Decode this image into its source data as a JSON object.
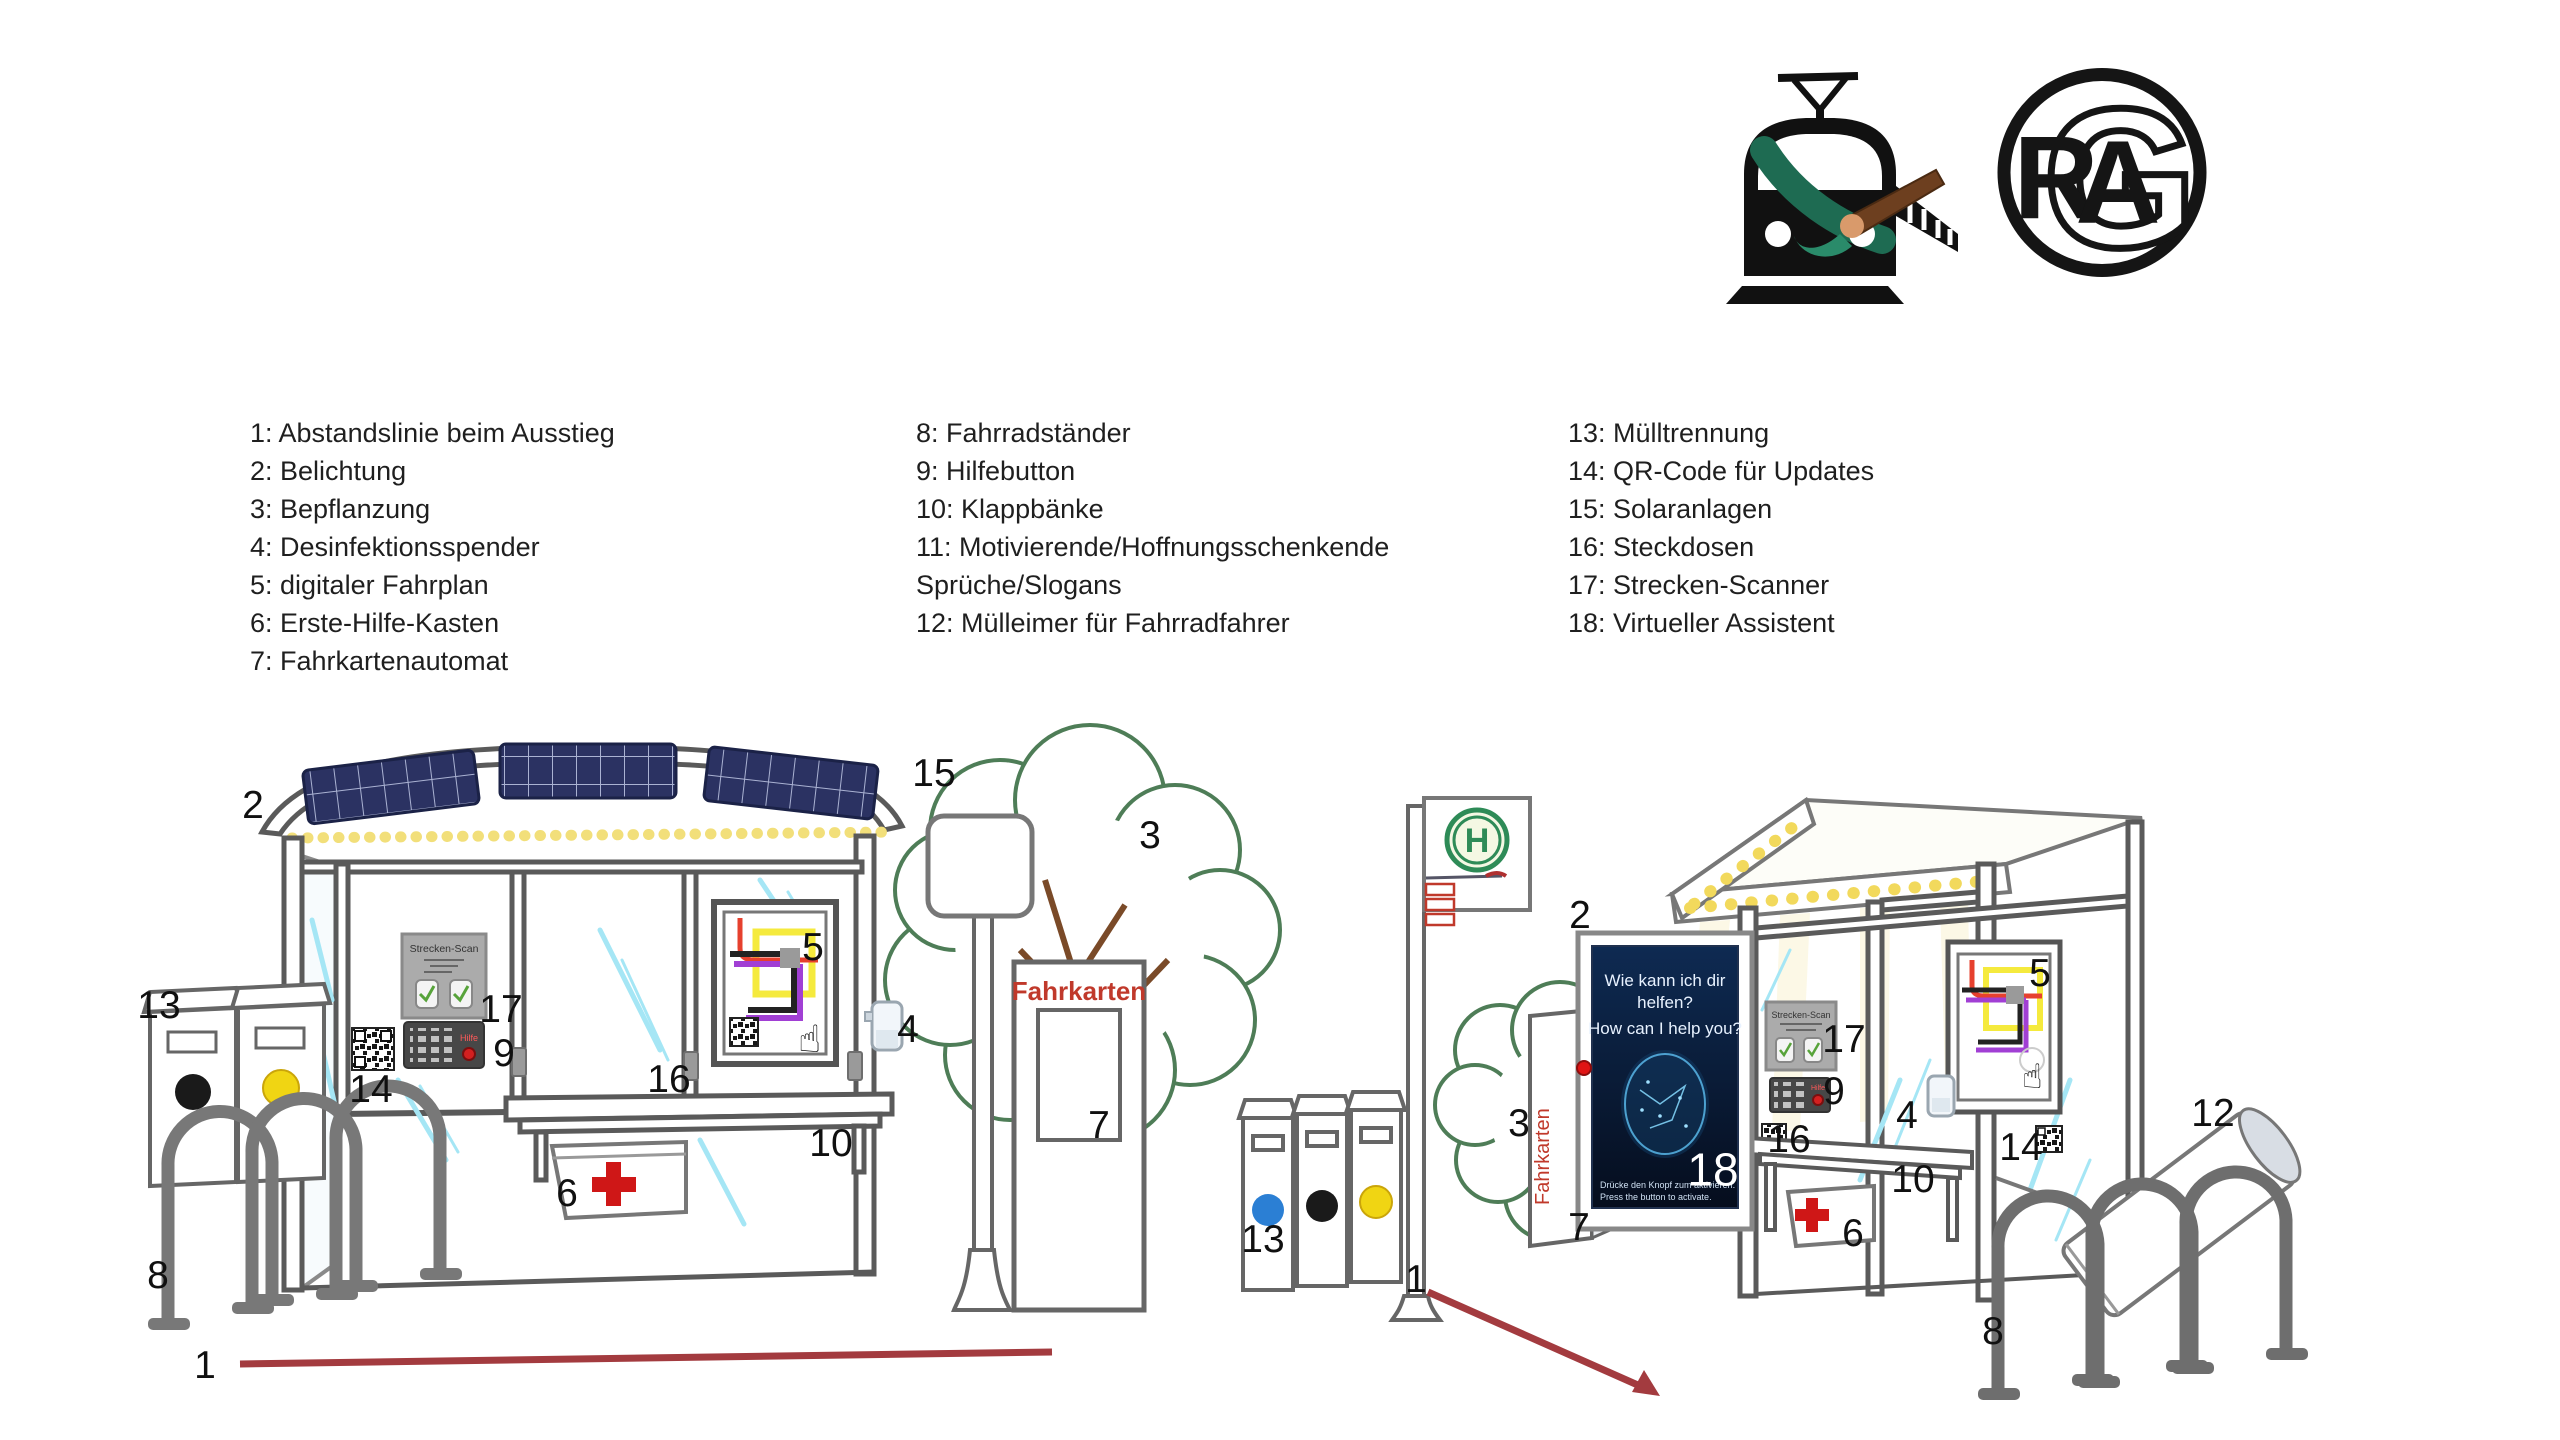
{
  "legend": {
    "columns": [
      {
        "lines": [
          "1: Abstandslinie beim Ausstieg",
          "2: Belichtung",
          "3: Bepflanzung",
          "4: Desinfektionsspender",
          "5: digitaler Fahrplan",
          "6: Erste-Hilfe-Kasten",
          "7: Fahrkartenautomat"
        ]
      },
      {
        "lines": [
          "8: Fahrradständer",
          "9: Hilfebutton",
          "10: Klappbänke",
          "11: Motivierende/Hoffnungsschenkende",
          "Sprüche/Slogans",
          "12: Mülleimer für Fahrradfahrer"
        ]
      },
      {
        "lines": [
          "13: Mülltrennung",
          "14: QR-Code für Updates",
          "15: Solaranlagen",
          "16: Steckdosen",
          "17: Strecken-Scanner",
          "18: Virtueller Assistent"
        ]
      }
    ]
  },
  "texts": {
    "strecken_scan": "Strecken-Scan",
    "hilfe": "Hilfe",
    "fahrkarten": "Fahrkarten",
    "h_letter": "H",
    "poster": {
      "l1": "Wie kann ich dir",
      "l2": "helfen?",
      "l3": "How can I help you?",
      "cap1": "Drücke den Knopf zum aktivieren.",
      "cap2": "Press the button to activate."
    }
  },
  "logos": {
    "train": {
      "name": "train-with-paintbrush"
    },
    "rag": {
      "r": "R",
      "a": "A",
      "g": "G"
    }
  },
  "markers": {
    "left": [
      {
        "n": "1",
        "x": 205,
        "y": 1368
      },
      {
        "n": "2",
        "x": 253,
        "y": 808
      },
      {
        "n": "3",
        "x": 1150,
        "y": 838
      },
      {
        "n": "4",
        "x": 908,
        "y": 1032
      },
      {
        "n": "5",
        "x": 813,
        "y": 950
      },
      {
        "n": "6",
        "x": 567,
        "y": 1196
      },
      {
        "n": "7",
        "x": 1099,
        "y": 1128
      },
      {
        "n": "8",
        "x": 158,
        "y": 1278
      },
      {
        "n": "9",
        "x": 504,
        "y": 1056
      },
      {
        "n": "10",
        "x": 831,
        "y": 1146
      },
      {
        "n": "13",
        "x": 159,
        "y": 1008
      },
      {
        "n": "14",
        "x": 371,
        "y": 1092
      },
      {
        "n": "15",
        "x": 934,
        "y": 776
      },
      {
        "n": "16",
        "x": 669,
        "y": 1082
      },
      {
        "n": "17",
        "x": 501,
        "y": 1012
      }
    ],
    "right": [
      {
        "n": "1",
        "x": 1416,
        "y": 1282
      },
      {
        "n": "2",
        "x": 1580,
        "y": 918
      },
      {
        "n": "3",
        "x": 1519,
        "y": 1126
      },
      {
        "n": "4",
        "x": 1907,
        "y": 1118
      },
      {
        "n": "5",
        "x": 2040,
        "y": 976
      },
      {
        "n": "6",
        "x": 1853,
        "y": 1236
      },
      {
        "n": "7",
        "x": 1579,
        "y": 1230
      },
      {
        "n": "8",
        "x": 1993,
        "y": 1334
      },
      {
        "n": "9",
        "x": 1834,
        "y": 1094
      },
      {
        "n": "10",
        "x": 1913,
        "y": 1182
      },
      {
        "n": "12",
        "x": 2213,
        "y": 1116
      },
      {
        "n": "13",
        "x": 1263,
        "y": 1242
      },
      {
        "n": "14",
        "x": 2021,
        "y": 1150
      },
      {
        "n": "16",
        "x": 1789,
        "y": 1142
      },
      {
        "n": "17",
        "x": 1844,
        "y": 1042
      },
      {
        "n": "18",
        "x": 1713,
        "y": 1172,
        "c": "#ffffff",
        "s": 46
      }
    ]
  },
  "colors": {
    "distance_line_red": "#a33b3f",
    "first_aid_red": "#cf1717",
    "fahrkarten_red": "#c0392b",
    "solar_panel_blue": "#2b3262",
    "light_strip_yellow": "#f2df7a",
    "glass_streak_cyan": "#a5e6f5",
    "tree_green": "#4e7d57",
    "h_sign_green": "#2e8b57",
    "poster_navy": "#0e2a52",
    "assistant_face_blue": "#58b6e8",
    "bin_sticker_blue": "#2b7fd4",
    "bin_sticker_yellow": "#f0d513",
    "bin_sticker_black": "#1a1a1a",
    "brush_brown": "#6d3f1f",
    "brush_tip_green": "#2a8b6a"
  }
}
